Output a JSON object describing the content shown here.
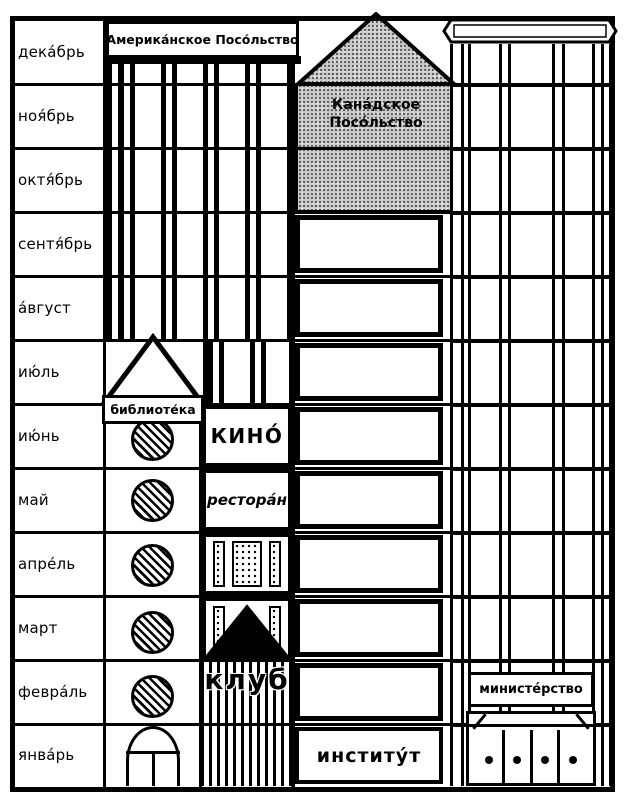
{
  "months": [
    {
      "label": "дека́брь"
    },
    {
      "label": "ноя́брь"
    },
    {
      "label": "октя́брь"
    },
    {
      "label": "сентя́брь"
    },
    {
      "label": "а́вгуст"
    },
    {
      "label": "ию́ль"
    },
    {
      "label": "ию́нь"
    },
    {
      "label": "май"
    },
    {
      "label": "апре́ль"
    },
    {
      "label": "март"
    },
    {
      "label": "февра́ль"
    },
    {
      "label": "янва́рь"
    }
  ],
  "buildings": {
    "american_embassy": {
      "sign": "Америка́нское Посо́льство"
    },
    "canadian_embassy": {
      "sign_line1": "Кана́дское",
      "sign_line2": "Посо́льство"
    },
    "library": {
      "sign": "библиоте́ка"
    },
    "cinema": {
      "label": "КИНО́"
    },
    "restaurant": {
      "label": "рестора́н"
    },
    "club": {
      "label": "клуб"
    },
    "institute": {
      "label": "институ́т"
    },
    "ministry": {
      "label": "министе́рство"
    }
  },
  "colors": {
    "ink": "#000000",
    "paper": "#ffffff",
    "stipple": "#c9c9c9"
  }
}
